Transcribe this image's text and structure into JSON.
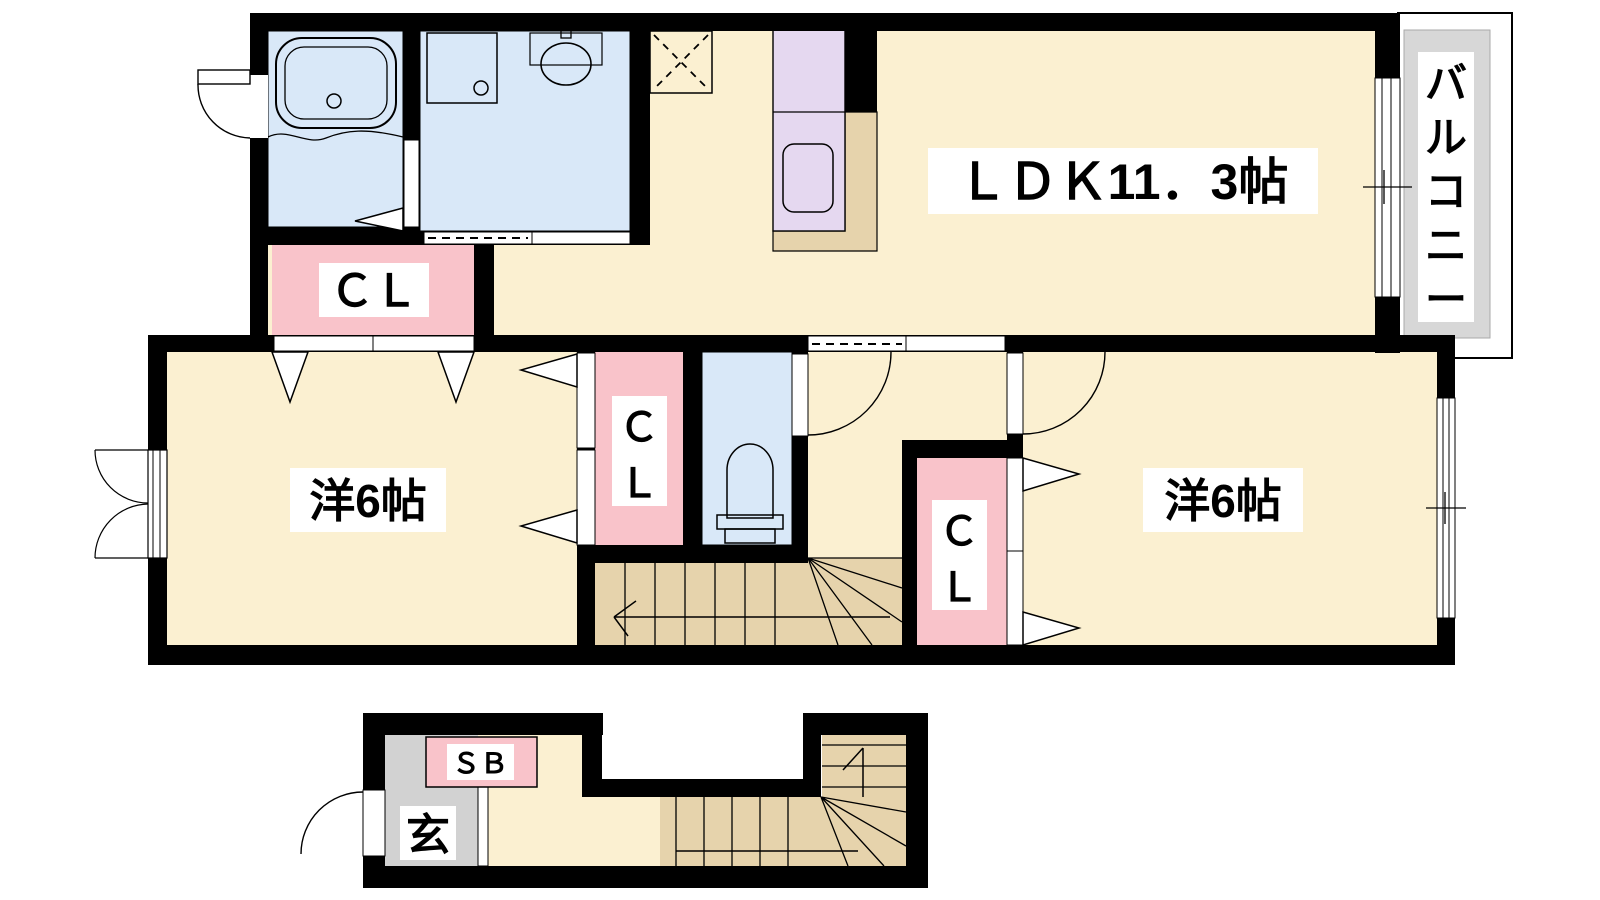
{
  "plan": {
    "type": "floor-plan",
    "rooms": {
      "ldk": {
        "label": "ＬＤＫ11．3帖"
      },
      "bedroom_left": {
        "label": "洋6帖"
      },
      "bedroom_right": {
        "label": "洋6帖"
      },
      "closet_top": {
        "label": "ＣＬ"
      },
      "closet_middle": {
        "chars": [
          "Ｃ",
          "Ｌ"
        ]
      },
      "closet_right": {
        "chars": [
          "Ｃ",
          "Ｌ"
        ]
      },
      "balcony": {
        "label": "バルコニー",
        "chars": [
          "バ",
          "ル",
          "コ",
          "ニ",
          "ー"
        ]
      },
      "shoe_box": {
        "label": "ＳＢ"
      },
      "entrance": {
        "label": "玄"
      }
    }
  },
  "colors": {
    "room_cream": "#FBF0D1",
    "water_blue": "#D9E8F8",
    "closet_pink": "#F9C3CA",
    "kitchen_purple": "#E5D8F0",
    "wood_tan": "#E6D3AC",
    "balcony_gray": "#D7D7D7",
    "entrance_gray": "#D2D2D2",
    "label_white": "#FFFFFF",
    "wall_black": "#000000"
  }
}
